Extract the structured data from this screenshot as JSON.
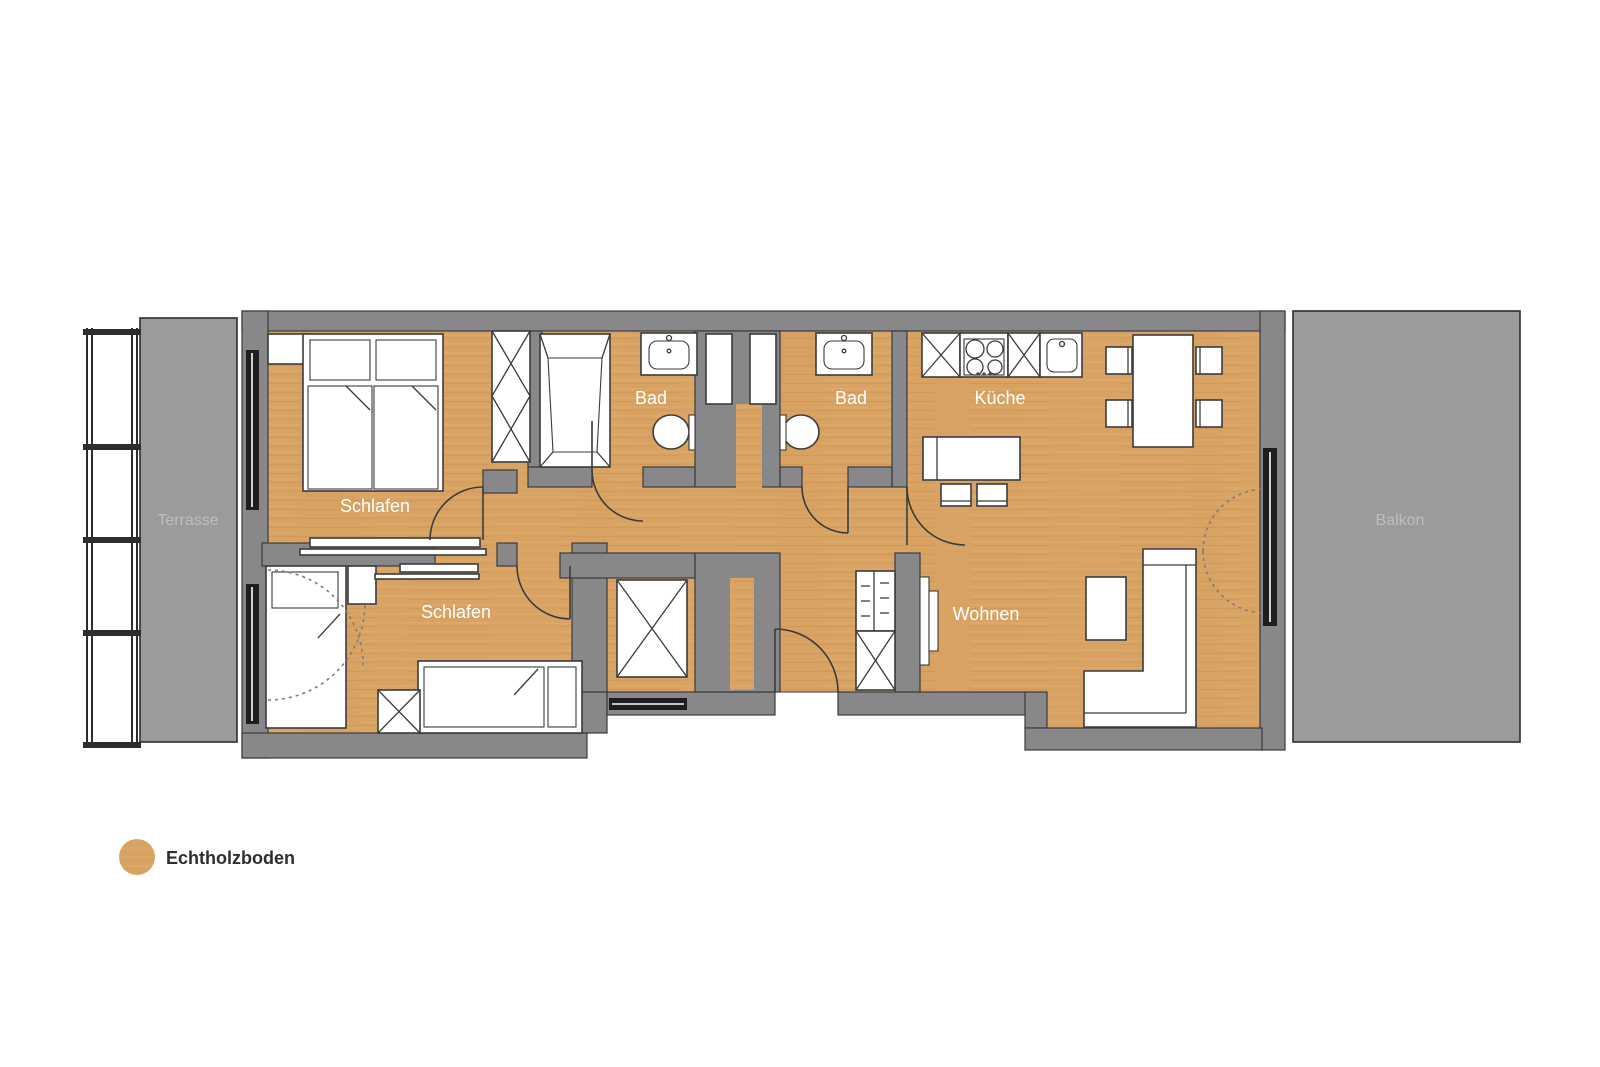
{
  "title": "Wohnungsgrundriss",
  "rooms": [
    {
      "id": "schlafen-1",
      "label": "Schlafen"
    },
    {
      "id": "schlafen-2",
      "label": "Schlafen"
    },
    {
      "id": "bad-1",
      "label": "Bad"
    },
    {
      "id": "bad-2",
      "label": "Bad"
    },
    {
      "id": "kueche",
      "label": "Küche"
    },
    {
      "id": "wohnen",
      "label": "Wohnen"
    },
    {
      "id": "terrasse",
      "label": "Terrasse"
    },
    {
      "id": "balkon",
      "label": "Balkon"
    }
  ],
  "legend": {
    "swatch": "wood-circle",
    "label": "Echtholzboden"
  },
  "colors": {
    "wood": "#D8A262",
    "woodLight": "#E5B77C",
    "woodDark": "#C08C4A",
    "wall": "#88888A",
    "outline": "#3B3B3C",
    "furnStroke": "#3B3B3C",
    "outdoor": "#9B9B9B",
    "outdoorLine": "#2D2D2D",
    "window": "#1E1E20",
    "roomLabel": "#FFFFFF",
    "outdoorLabel": "#BFBEBD",
    "legendText": "#2E2E2F",
    "dash": "#7C7C7C"
  }
}
